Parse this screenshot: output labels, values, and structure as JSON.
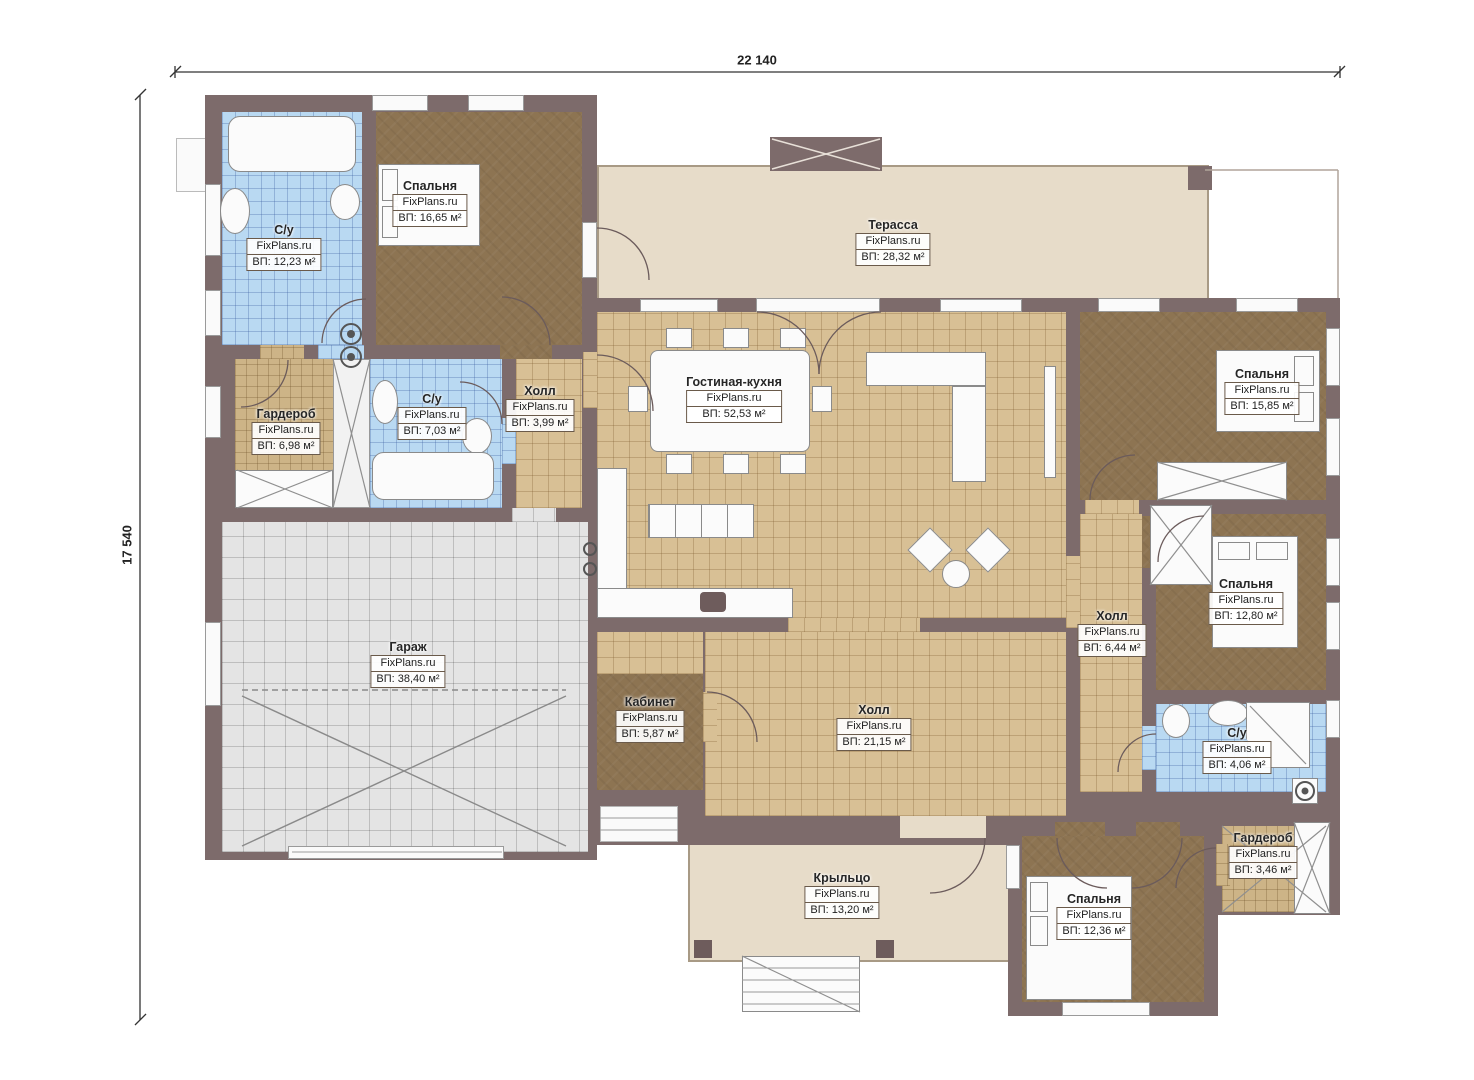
{
  "watermark": "FixPlans.ru",
  "dimensions": {
    "width_label": "22 140",
    "height_label": "17 540"
  },
  "rooms": [
    {
      "id": "bathroom-1",
      "name": "С/у",
      "area": "ВП: 12,23 м²"
    },
    {
      "id": "bedroom-1",
      "name": "Спальня",
      "area": "ВП: 16,65 м²"
    },
    {
      "id": "wardrobe-1",
      "name": "Гардероб",
      "area": "ВП: 6,98 м²"
    },
    {
      "id": "bathroom-2",
      "name": "С/у",
      "area": "ВП: 7,03 м²"
    },
    {
      "id": "hall-1",
      "name": "Холл",
      "area": "ВП: 3,99 м²"
    },
    {
      "id": "terrace",
      "name": "Терасса",
      "area": "ВП: 28,32 м²"
    },
    {
      "id": "living",
      "name": "Гостиная-кухня",
      "area": "ВП: 52,53 м²"
    },
    {
      "id": "garage",
      "name": "Гараж",
      "area": "ВП: 38,40 м²"
    },
    {
      "id": "office",
      "name": "Кабинет",
      "area": "ВП: 5,87 м²"
    },
    {
      "id": "hall-2",
      "name": "Холл",
      "area": "ВП: 21,15 м²"
    },
    {
      "id": "bedroom-2",
      "name": "Спальня",
      "area": "ВП: 15,85 м²"
    },
    {
      "id": "hall-3",
      "name": "Холл",
      "area": "ВП: 6,44 м²"
    },
    {
      "id": "bedroom-3",
      "name": "Спальня",
      "area": "ВП: 12,80 м²"
    },
    {
      "id": "bathroom-3",
      "name": "С/у",
      "area": "ВП: 4,06 м²"
    },
    {
      "id": "wardrobe-2",
      "name": "Гардероб",
      "area": "ВП: 3,46 м²"
    },
    {
      "id": "porch",
      "name": "Крыльцо",
      "area": "ВП: 13,20 м²"
    },
    {
      "id": "bedroom-4",
      "name": "Спальня",
      "area": "ВП: 12,36 м²"
    }
  ],
  "palette": {
    "wall": "#7d6b6b",
    "wood_floor": "#8d7452",
    "tile_floor": "#d8c095",
    "bath_floor": "#b9d9f2",
    "garage_floor": "#e4e4e4",
    "terrace_floor": "#e7dcc9",
    "furniture": "#fbfbfb"
  }
}
